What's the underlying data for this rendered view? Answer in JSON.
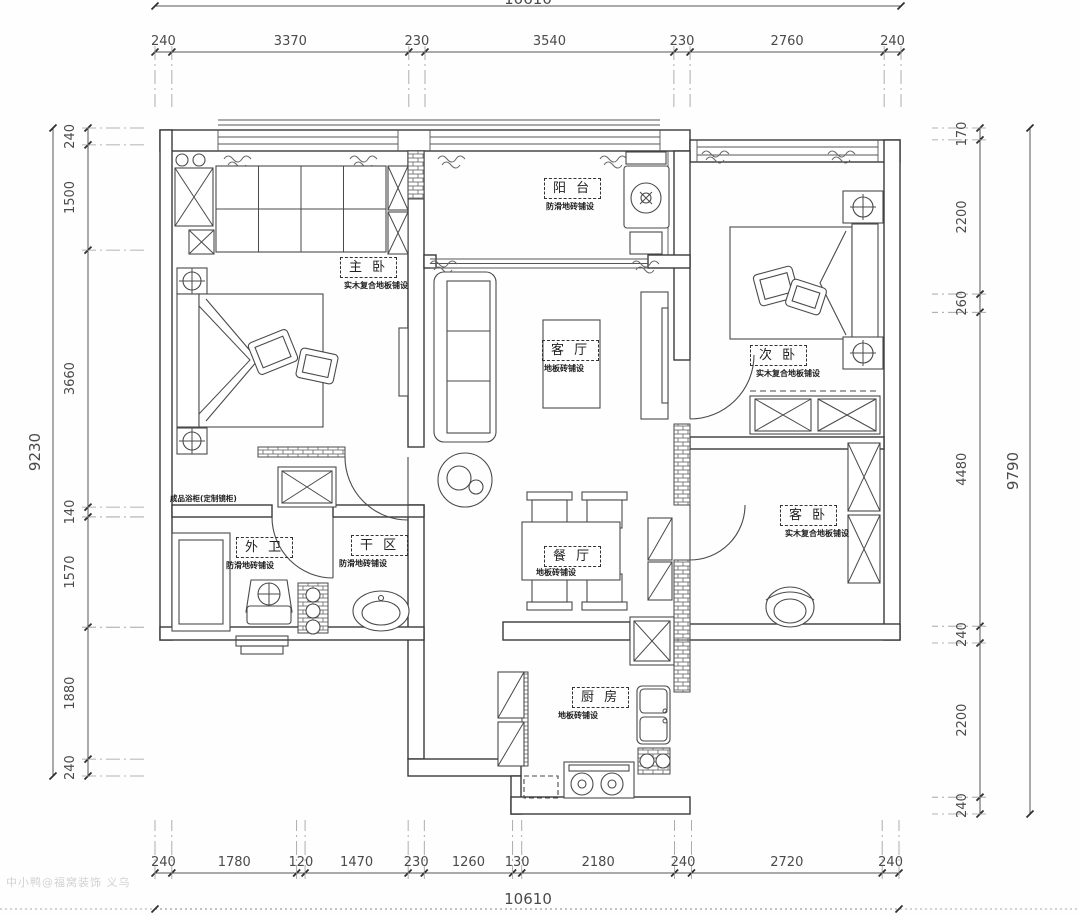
{
  "watermark": "中小鸭@福窝装饰 义乌",
  "dimensions": {
    "top": {
      "total": "10610",
      "segments": [
        "240",
        "3370",
        "230",
        "3540",
        "230",
        "2760",
        "240"
      ]
    },
    "bottom": {
      "total": "10610",
      "segments": [
        "240",
        "1780",
        "120",
        "1470",
        "230",
        "1260",
        "130",
        "2180",
        "240",
        "2720",
        "240"
      ]
    },
    "left": {
      "total": "9230",
      "segments": [
        "240",
        "1500",
        "3660",
        "140",
        "1570",
        "1880",
        "240"
      ]
    },
    "right": {
      "total": "9790",
      "segments": [
        "170",
        "2200",
        "260",
        "4480",
        "240",
        "2200",
        "240"
      ]
    }
  },
  "rooms": [
    {
      "id": "balcony",
      "name": "阳 台",
      "note": "防滑地砖铺设"
    },
    {
      "id": "master-bedroom",
      "name": "主 卧",
      "note": "实木复合地板铺设"
    },
    {
      "id": "living-room",
      "name": "客 厅",
      "note": "地板砖铺设"
    },
    {
      "id": "bedroom-2",
      "name": "次 卧",
      "note": "实木复合地板铺设"
    },
    {
      "id": "guest-bedroom",
      "name": "客 卧",
      "note": "实木复合地板铺设"
    },
    {
      "id": "dining-room",
      "name": "餐 厅",
      "note": "地板砖铺设"
    },
    {
      "id": "bathroom",
      "name": "外 卫",
      "note": "防滑地砖铺设"
    },
    {
      "id": "dry-area",
      "name": "干 区",
      "note": "防滑地砖铺设"
    },
    {
      "id": "kitchen",
      "name": "厨 房",
      "note": "地板砖铺设"
    }
  ],
  "annotations": [
    {
      "id": "vanity-note",
      "text": "成品浴柜(定制镜柜)"
    }
  ]
}
